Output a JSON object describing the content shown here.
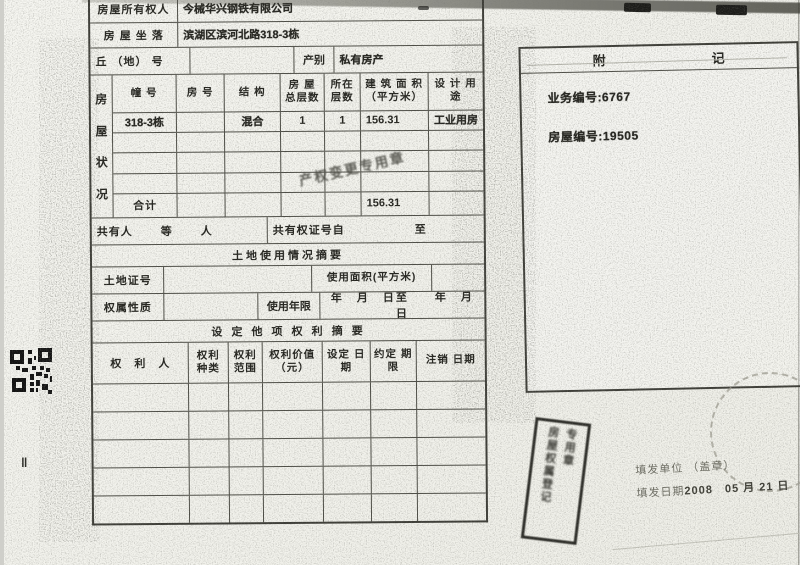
{
  "form": {
    "owner_label": "房屋所有权人",
    "owner_value": "今械华兴钢铁有限公司",
    "location_label": "房 屋 坐 落",
    "location_value": "滨湖区滨河北路318-3栋",
    "qiu_label": "丘 （地） 号",
    "chanbie_label": "产别",
    "chanbie_value": "私有房产",
    "house": {
      "side_label": [
        "房",
        "屋",
        "状",
        "况"
      ],
      "headers": [
        "幢 号",
        "房 号",
        "结 构",
        "房 屋 总层数",
        "所在 层数",
        "建 筑 面 积 （平方米）",
        "设 计 用 途"
      ],
      "row": {
        "zhuang": "318-3栋",
        "fang": "",
        "jiegou": "混合",
        "floors_total": "1",
        "floor": "1",
        "area": "156.31",
        "use": "工业用房"
      },
      "total_label": "合计",
      "total_area": "156.31"
    },
    "coowner": {
      "label": "共有人",
      "deng": "等",
      "ren": "人",
      "cert_label": "共有权证号自",
      "zhi": "至"
    },
    "land": {
      "section_title": "土地使用情况摘要",
      "cert_label": "土地证号",
      "area_label": "使用面积(平方米)",
      "nature_label": "权属性质",
      "term_label": "使用年限",
      "term_value": "年　月　日至　　年　月　日"
    },
    "rights": {
      "section_title": "设 定 他 项 权 利 摘 要",
      "headers": [
        "权　利　人",
        "权利 种类",
        "权利 范围",
        "权利价值 （元）",
        "设定 日期",
        "约定 期限",
        "注销 日期"
      ]
    },
    "annex": {
      "fu": "附",
      "ji": "记",
      "business_no": "业务编号:6767",
      "house_no": "房屋编号:19505"
    },
    "issue": {
      "unit_label": "填发单位",
      "seal_hint": "（盖章）",
      "date_label": "填发日期",
      "date_value": "2008　05 月 21 日"
    },
    "stamps": {
      "diagonal_text": "产权变更专用章",
      "rect_col1": "房屋权属登记",
      "rect_col2": "专用章"
    }
  }
}
